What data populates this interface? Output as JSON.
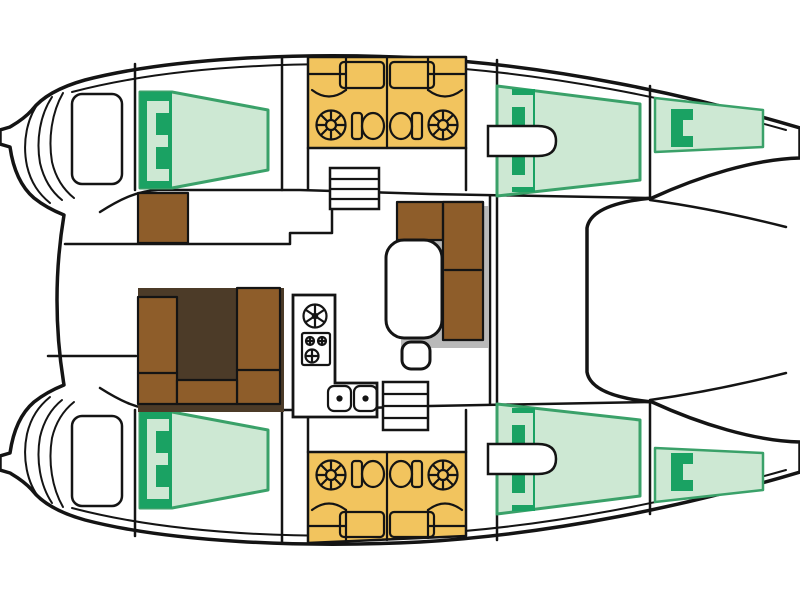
{
  "diagram": {
    "type": "boat-floor-plan",
    "title": "Catamaran interior layout — top-view floor plan",
    "vessel": "sailing catamaran",
    "orientation": {
      "bow": "right",
      "stern": "left",
      "port_hull": "top",
      "starboard_hull": "bottom"
    },
    "canvas": {
      "width": 800,
      "height": 600
    },
    "colors": {
      "background": "#ffffff",
      "outline": "#141414",
      "berth_light": "#cde8d3",
      "berth_edge": "#3aa169",
      "berth_dark": "#1aa263",
      "head_yellow": "#f2c45e",
      "wood_brown": "#8e5d2a",
      "shadow_gray": "#b9b9b9",
      "shadow_dark": "#4c3b28"
    },
    "areas": [
      {
        "id": "port-aft-cabin",
        "label": "Port aft cabin with double berth"
      },
      {
        "id": "port-heads",
        "label": "Port twin heads with showers, toilets and sinks"
      },
      {
        "id": "port-forward-cabin",
        "label": "Port forward cabin with double berth"
      },
      {
        "id": "port-forepeak",
        "label": "Port forepeak berth"
      },
      {
        "id": "starboard-aft-cabin",
        "label": "Starboard aft cabin with double berth"
      },
      {
        "id": "starboard-heads",
        "label": "Starboard twin heads with showers, toilets and sinks"
      },
      {
        "id": "starboard-forward-cabin",
        "label": "Starboard forward cabin with double berth"
      },
      {
        "id": "starboard-forepeak",
        "label": "Starboard forepeak berth"
      },
      {
        "id": "saloon",
        "label": "Saloon with L-settee, table and stool"
      },
      {
        "id": "galley",
        "label": "L-shaped galley with stove, round hatch and twin sinks"
      },
      {
        "id": "cockpit",
        "label": "Aft cockpit with U-settee and side seat"
      },
      {
        "id": "transoms",
        "label": "Twin transom swim platforms with steps"
      },
      {
        "id": "foredeck",
        "label": "Foredeck between bows"
      }
    ],
    "fixtures": {
      "double_berths": 4,
      "forepeak_berths": 2,
      "heads_compartments": 4,
      "showers": 4,
      "toilets": 4,
      "galley_sinks": 2,
      "stove_burners": 3,
      "companionway_stairs": 2
    }
  }
}
